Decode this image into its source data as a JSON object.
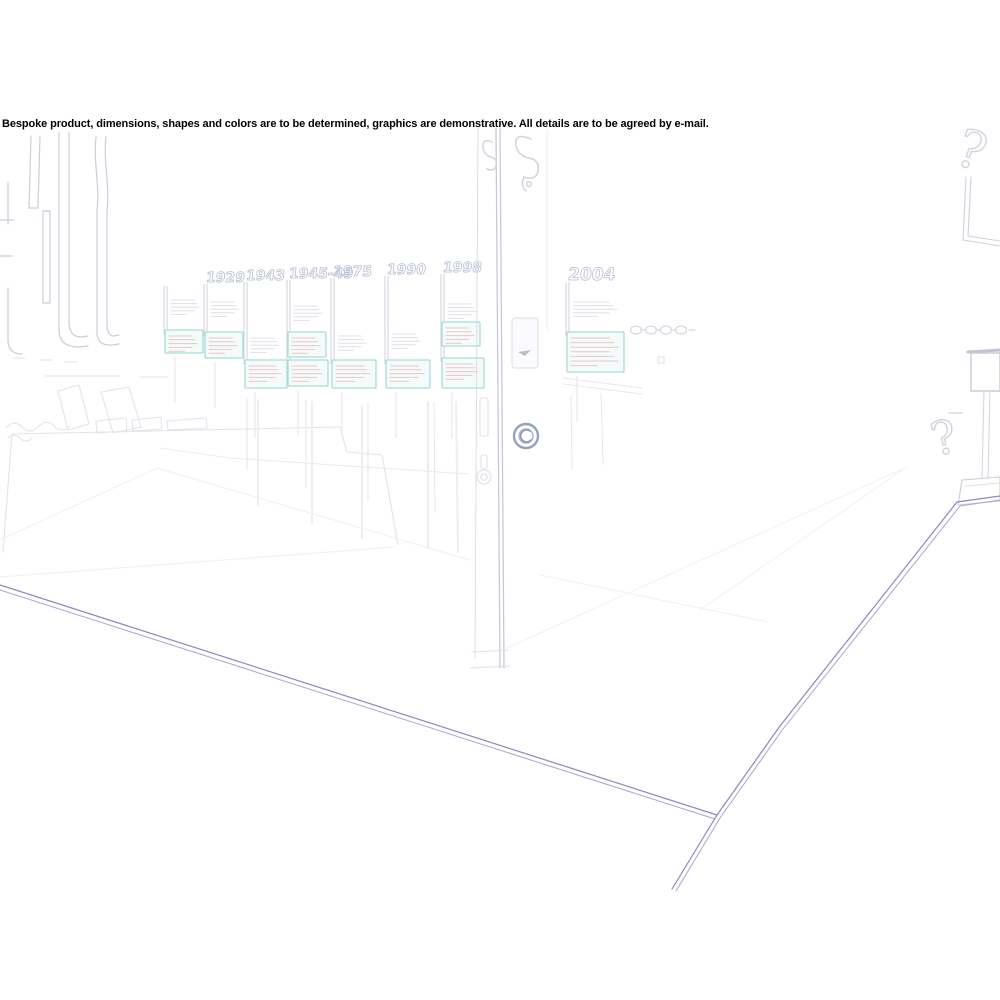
{
  "disclaimer": "Bespoke product, dimensions, shapes and colors are to be determined, graphics are demonstrative. All details are to be agreed by e-mail.",
  "image": {
    "kind": "faded line-art sketch of a museum exhibition room with timeline wall, door and info kiosk",
    "background": "#ffffff"
  },
  "colors": {
    "line_faint": "#ececf2",
    "line_light": "#dfe0e8",
    "line_mid": "#cfd0dc",
    "line_dark": "#b7bdd2",
    "lock_ring": "#95a0bf",
    "teal": "#a8dcd8",
    "teal_fill": "#f5fbfb",
    "pink": "#e8c7c7",
    "purple": "#8f86c0",
    "text": "#000000"
  },
  "timeline": {
    "years": [
      "",
      "1929",
      "1943",
      "1945-49",
      "1975",
      "1990",
      "1998"
    ],
    "door_year": "2004"
  }
}
